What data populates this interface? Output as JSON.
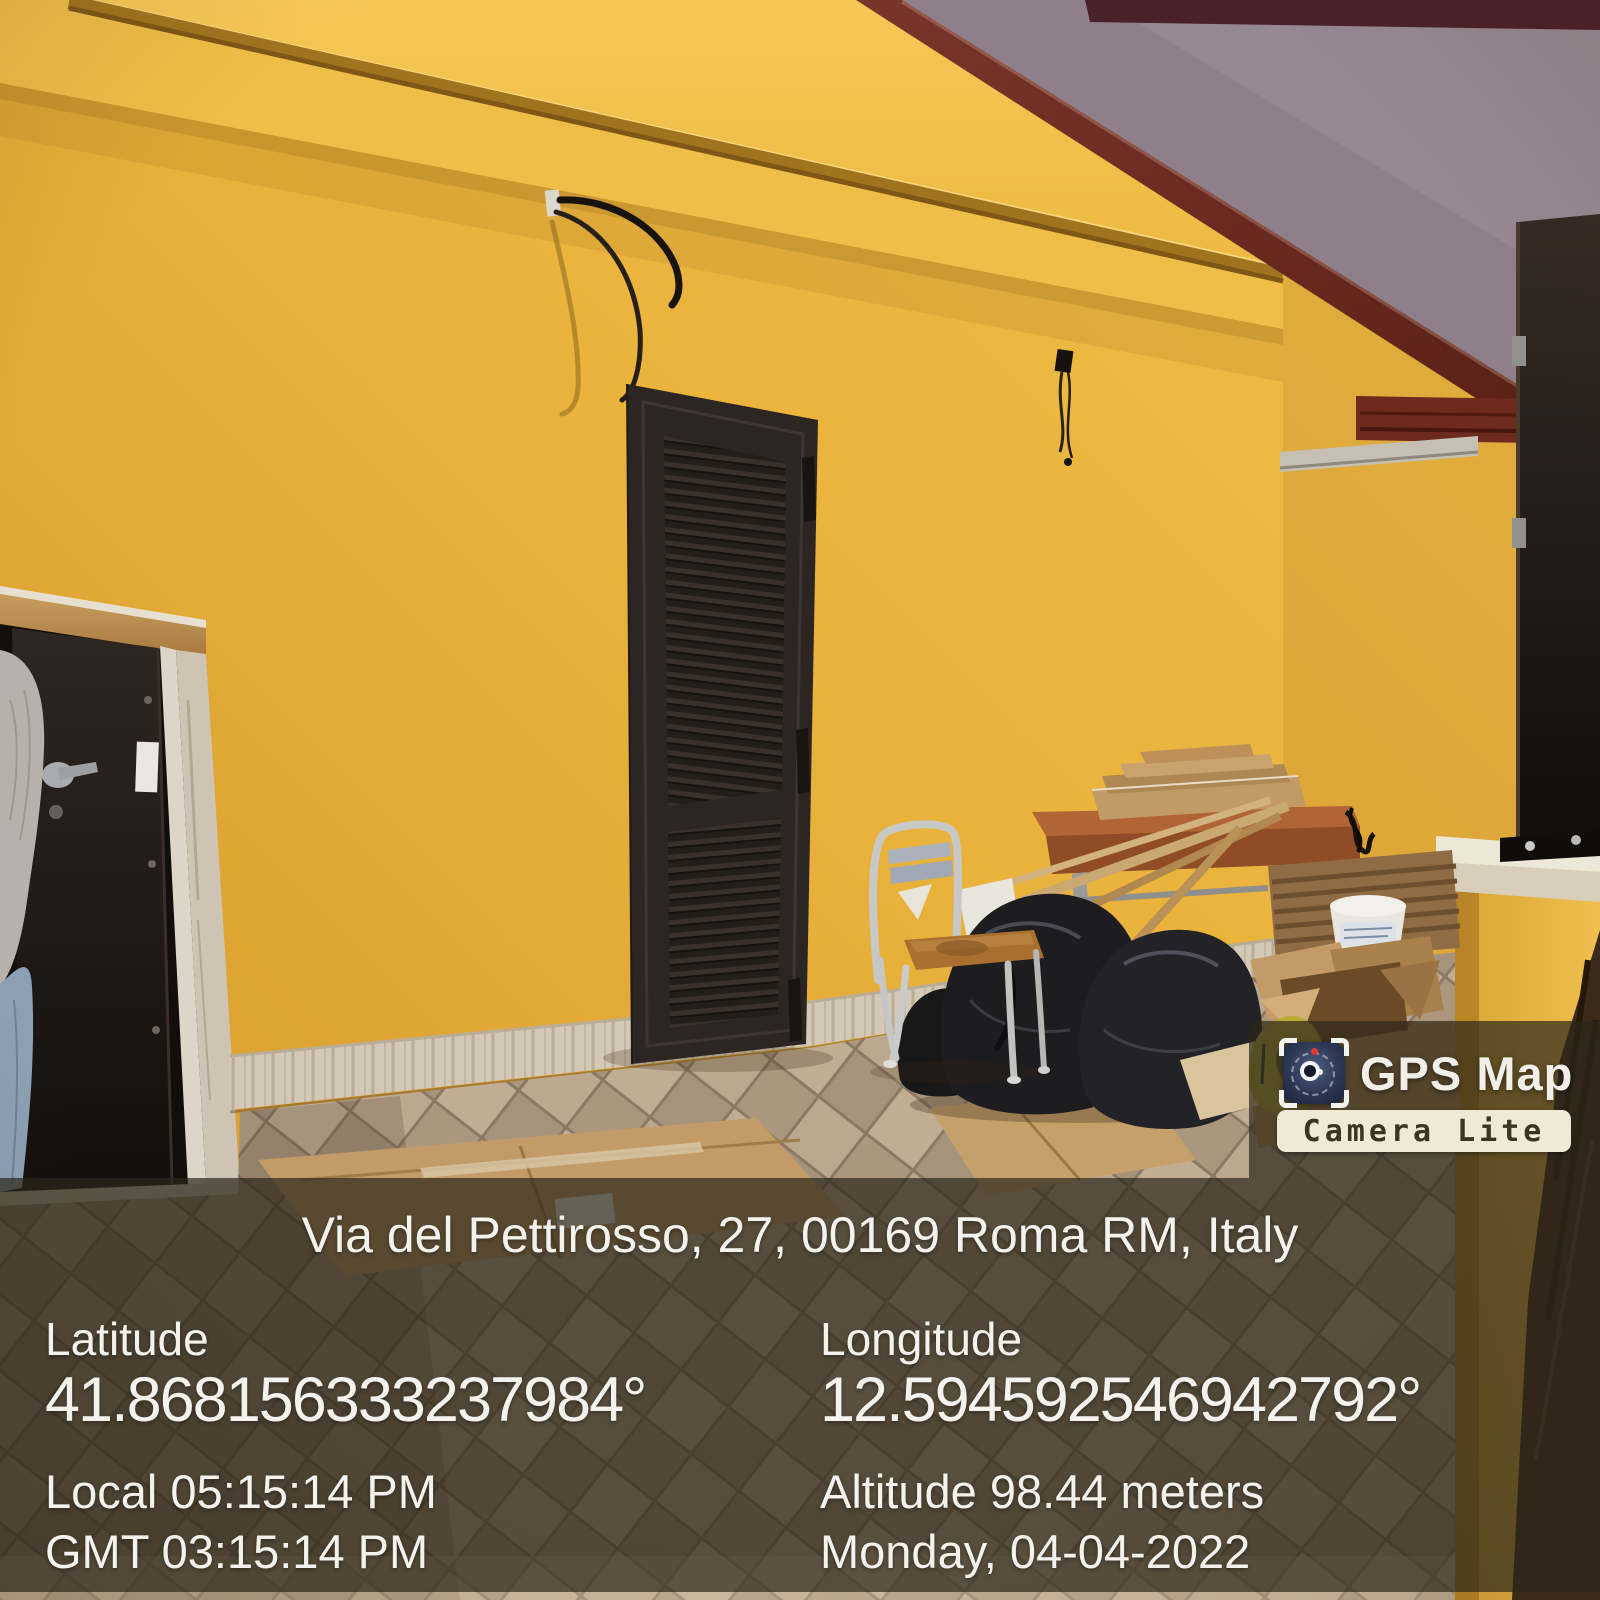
{
  "photo": {
    "alt": "Yellow stucco house exterior with dark louvered shutter door, open entry door, metal chair, wooden table and construction debris on a tiled terrace",
    "colors": {
      "wall_yellow": "#E8B13A",
      "wall_yellow_light": "#F2C351",
      "cornice_trim": "#A0741F",
      "gable_fascia_maroon": "#6E2D20",
      "neighbor_wall_purple": "#8F7F8A",
      "roof_strip_maroon": "#4A202A",
      "shutter_brown": "#2C2522",
      "door_opening": "#120E0B",
      "floor_tan": "#B19E86",
      "skirting": "#D3C9B6",
      "ledge_cream": "#EDE7D7",
      "trash_bag_black": "#1D1C1F",
      "cardboard_tan": "#C39B68",
      "chair_seat_wood": "#A9702F",
      "table_wood": "#B16536"
    }
  },
  "watermark": {
    "app_name": "GPS Map",
    "edition_badge": "Camera Lite",
    "icon": "gps-map-camera-app-icon",
    "panel_bg": "rgba(44,38,26,0.70)",
    "badge_bg": "#EFE9D6"
  },
  "overlay": {
    "text_color": "#F4F2ED",
    "address": "Via del Pettirosso, 27, 00169 Roma RM, Italy",
    "latitude_label": "Latitude",
    "latitude_value": "41.868156333237984°",
    "longitude_label": "Longitude",
    "longitude_value": "12.594592546942792°",
    "local_time": "Local 05:15:14 PM",
    "gmt_time": "GMT 03:15:14 PM",
    "altitude": "Altitude 98.44 meters",
    "date": "Monday, 04-04-2022"
  }
}
